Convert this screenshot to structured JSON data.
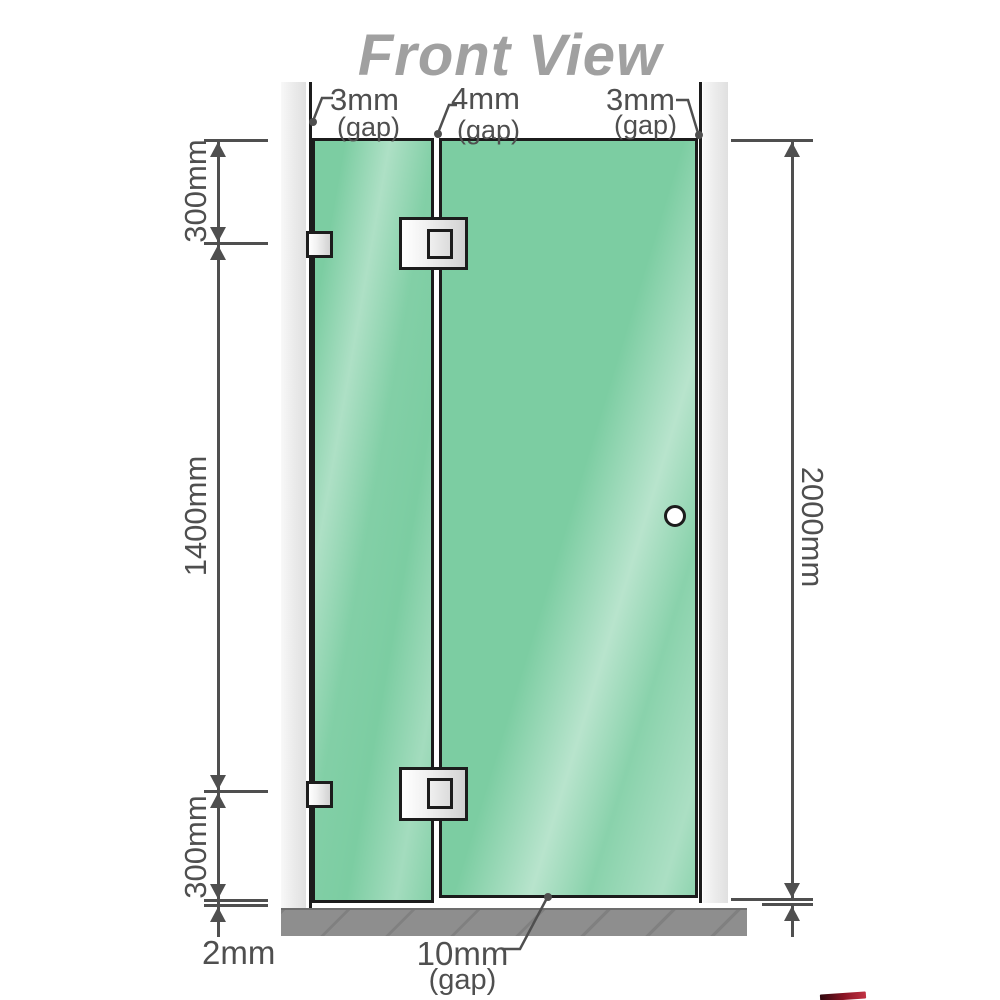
{
  "title": "Front View",
  "top_gap_labels": [
    {
      "value": "3mm",
      "unit": "(gap)"
    },
    {
      "value": "4mm",
      "unit": "(gap)"
    },
    {
      "value": "3mm",
      "unit": "(gap)"
    }
  ],
  "left_dimensions": {
    "top_segment": "300mm",
    "middle_segment": "1400mm",
    "bottom_segment": "300mm",
    "floor_gap": "2mm"
  },
  "right_dimensions": {
    "total_height": "2000mm"
  },
  "bottom_gap_label": {
    "value": "10mm",
    "unit": "(gap)"
  },
  "colors": {
    "glass": "#7ccda2",
    "wall": "#e9e9e9",
    "floor": "#8e8e8e",
    "outline": "#1c1c1c",
    "dim": "#4f4f4f",
    "title_color": "#a0a0a0",
    "accent_red": "#8e1626"
  }
}
